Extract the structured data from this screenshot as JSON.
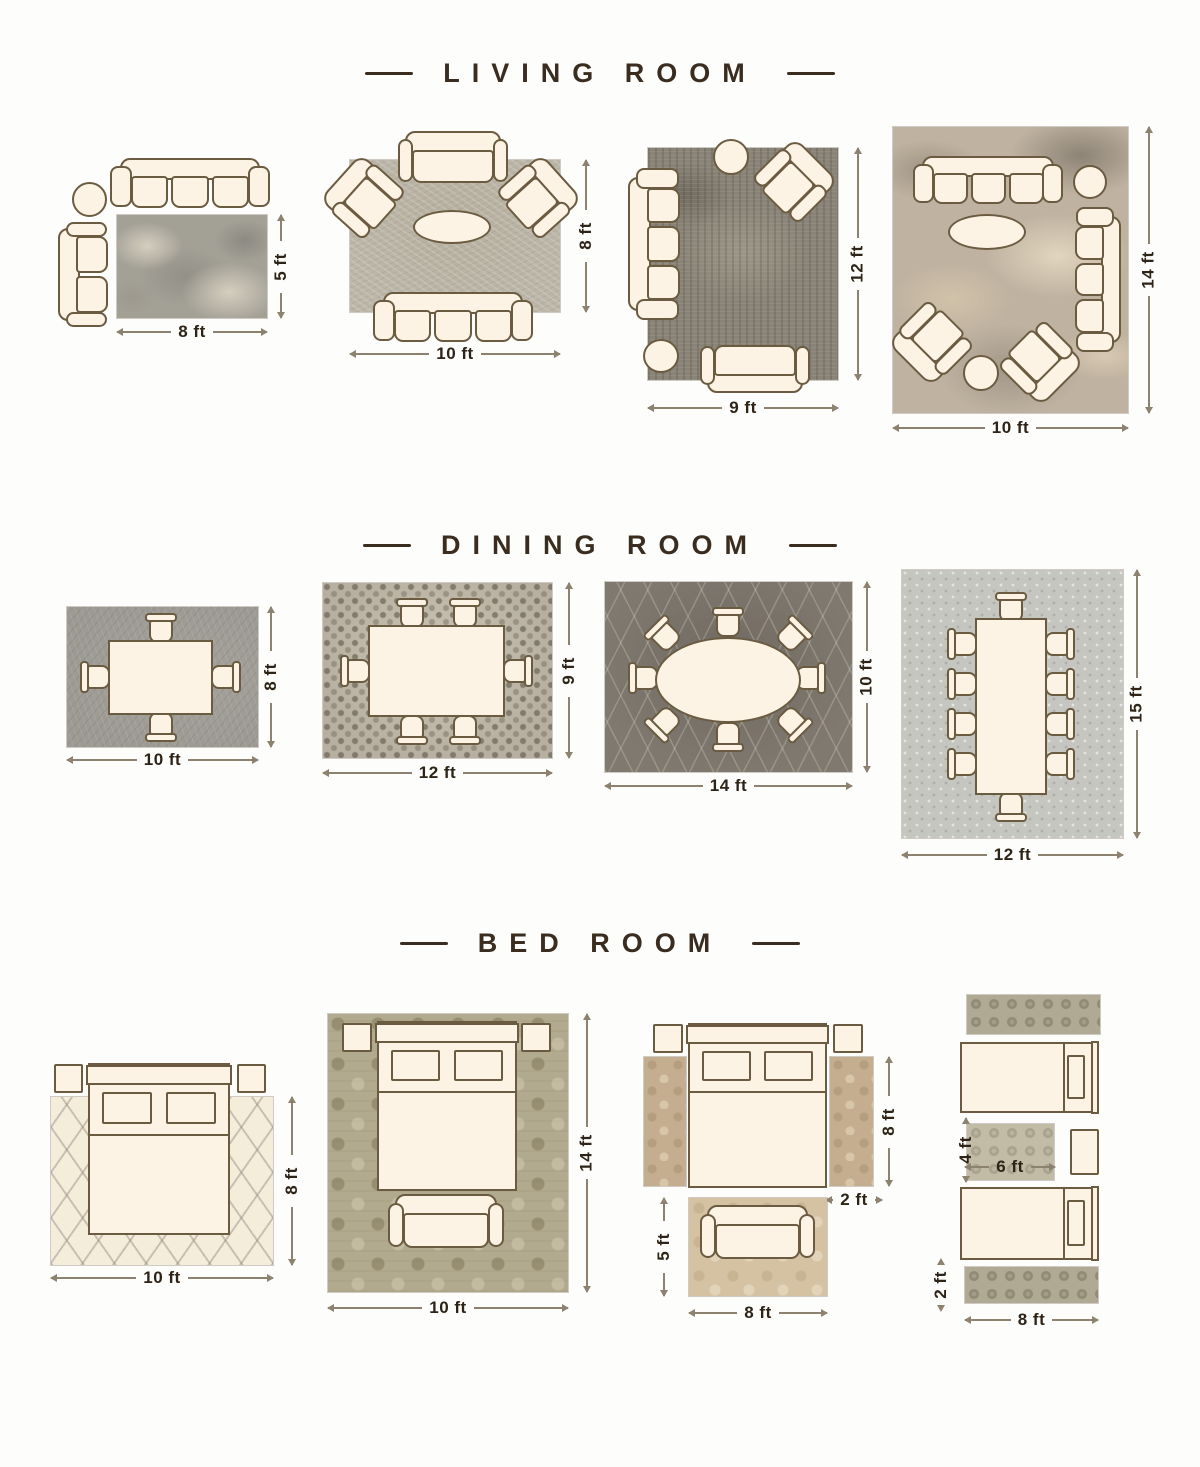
{
  "sections": {
    "living": {
      "title": "LIVING ROOM",
      "layouts": [
        {
          "w": "8 ft",
          "h": "5 ft"
        },
        {
          "w": "10 ft",
          "h": "8 ft"
        },
        {
          "w": "9 ft",
          "h": "12 ft"
        },
        {
          "w": "10 ft",
          "h": "14 ft"
        }
      ]
    },
    "dining": {
      "title": "DINING ROOM",
      "layouts": [
        {
          "w": "10 ft",
          "h": "8 ft"
        },
        {
          "w": "12 ft",
          "h": "9 ft"
        },
        {
          "w": "14 ft",
          "h": "10 ft"
        },
        {
          "w": "12 ft",
          "h": "15 ft"
        }
      ]
    },
    "bedroom": {
      "title": "BED ROOM",
      "layouts": [
        {
          "w": "10 ft",
          "h": "8 ft"
        },
        {
          "w": "10 ft",
          "h": "14 ft"
        },
        {
          "runner_length": "8 ft",
          "runner_width": "2 ft",
          "rug_height": "5 ft",
          "rug_width": "8 ft"
        },
        {
          "mid_rug_height": "4 ft",
          "mid_rug_width": "6 ft",
          "runner_height": "2 ft",
          "runner_width": "8 ft"
        }
      ]
    }
  },
  "colors": {
    "fill": "#fcf3e4",
    "line": "#6b5b41",
    "dimc": "#2d2316",
    "dimline": "#8d8170",
    "header": "#3a2d20",
    "bg": "#fdfdfb"
  }
}
